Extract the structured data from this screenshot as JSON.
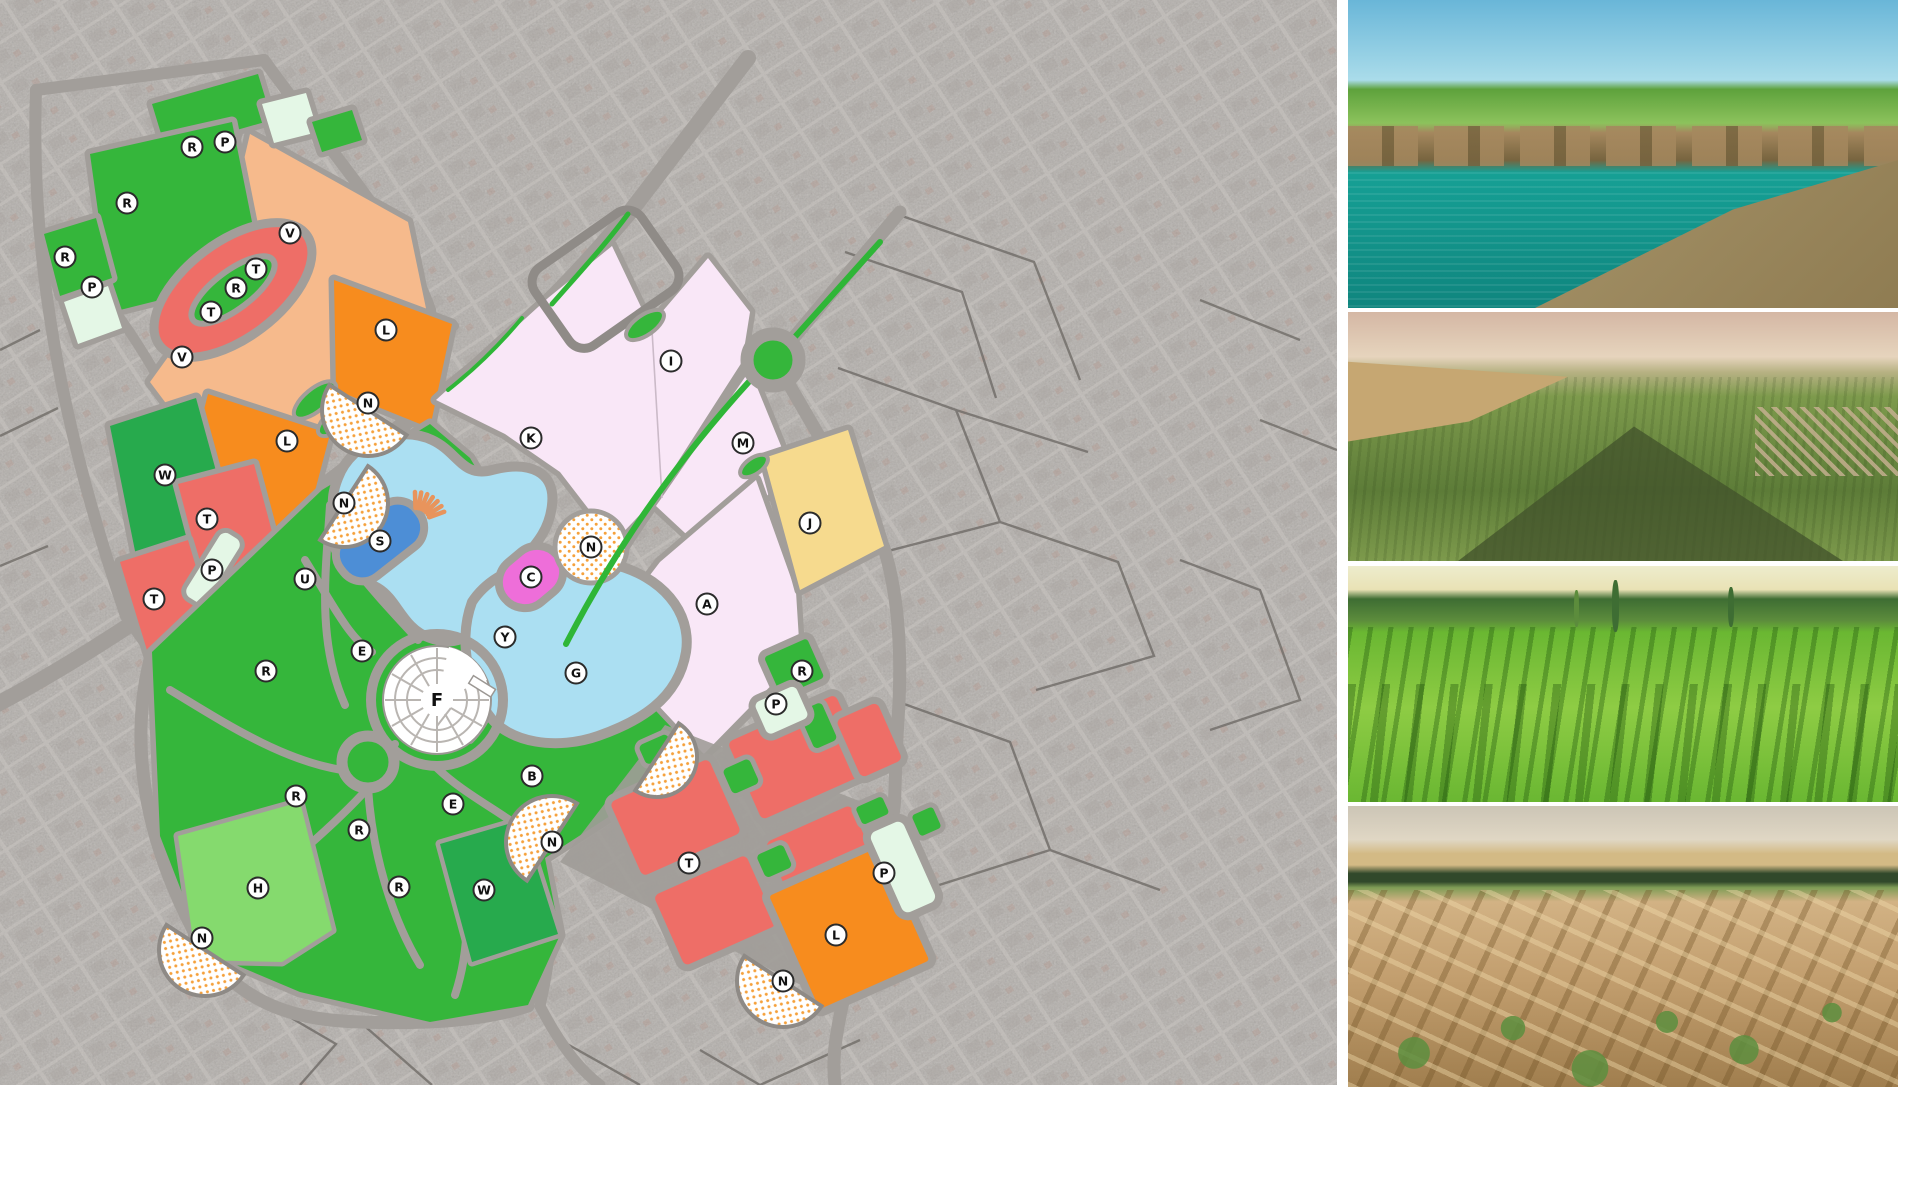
{
  "map": {
    "palette": {
      "sat": "#b4b0ac",
      "satline": "#c9c5c1",
      "road": "#a29e9a",
      "roadedge": "#6f6b67",
      "green": "#35b63b",
      "dgreen": "#27aa4d",
      "lgreen": "#85da6e",
      "mint": "#e4f7e6",
      "peach": "#f6ba8c",
      "red": "#ee6e67",
      "orange": "#f78c1e",
      "pink": "#f9e7f7",
      "yellow": "#f6da8e",
      "lake": "#abdff2",
      "pond": "#4d8ed6",
      "magenta": "#ee6ed9",
      "dot": "#f5a13c",
      "marker_ring": "#2b2b2b",
      "marker_text": "#111111",
      "sun": "#e8945c"
    },
    "markers": [
      {
        "letter": "R",
        "x": 192,
        "y": 147
      },
      {
        "letter": "P",
        "x": 225,
        "y": 142
      },
      {
        "letter": "R",
        "x": 127,
        "y": 203
      },
      {
        "letter": "R",
        "x": 65,
        "y": 257
      },
      {
        "letter": "P",
        "x": 92,
        "y": 287
      },
      {
        "letter": "V",
        "x": 290,
        "y": 233
      },
      {
        "letter": "T",
        "x": 256,
        "y": 269
      },
      {
        "letter": "R",
        "x": 236,
        "y": 288
      },
      {
        "letter": "T",
        "x": 211,
        "y": 312
      },
      {
        "letter": "V",
        "x": 182,
        "y": 357
      },
      {
        "letter": "L",
        "x": 386,
        "y": 330
      },
      {
        "letter": "N",
        "x": 368,
        "y": 403
      },
      {
        "letter": "L",
        "x": 287,
        "y": 441
      },
      {
        "letter": "W",
        "x": 165,
        "y": 475
      },
      {
        "letter": "T",
        "x": 207,
        "y": 519
      },
      {
        "letter": "P",
        "x": 212,
        "y": 570
      },
      {
        "letter": "T",
        "x": 154,
        "y": 599
      },
      {
        "letter": "U",
        "x": 305,
        "y": 579
      },
      {
        "letter": "N",
        "x": 344,
        "y": 503
      },
      {
        "letter": "K",
        "x": 531,
        "y": 438
      },
      {
        "letter": "I",
        "x": 671,
        "y": 361
      },
      {
        "letter": "M",
        "x": 743,
        "y": 443
      },
      {
        "letter": "S",
        "x": 380,
        "y": 541
      },
      {
        "letter": "C",
        "x": 531,
        "y": 577
      },
      {
        "letter": "N",
        "x": 591,
        "y": 547
      },
      {
        "letter": "Y",
        "x": 505,
        "y": 637
      },
      {
        "letter": "A",
        "x": 707,
        "y": 604
      },
      {
        "letter": "G",
        "x": 576,
        "y": 673
      },
      {
        "letter": "F",
        "x": 437,
        "y": 700,
        "plain": true
      },
      {
        "letter": "E",
        "x": 362,
        "y": 651
      },
      {
        "letter": "R",
        "x": 266,
        "y": 671
      },
      {
        "letter": "R",
        "x": 296,
        "y": 796
      },
      {
        "letter": "E",
        "x": 453,
        "y": 804
      },
      {
        "letter": "B",
        "x": 532,
        "y": 776
      },
      {
        "letter": "R",
        "x": 359,
        "y": 830
      },
      {
        "letter": "H",
        "x": 258,
        "y": 888
      },
      {
        "letter": "R",
        "x": 399,
        "y": 887
      },
      {
        "letter": "W",
        "x": 484,
        "y": 890
      },
      {
        "letter": "N",
        "x": 202,
        "y": 938
      },
      {
        "letter": "N",
        "x": 552,
        "y": 842
      },
      {
        "letter": "T",
        "x": 689,
        "y": 863
      },
      {
        "letter": "J",
        "x": 810,
        "y": 523
      },
      {
        "letter": "R",
        "x": 802,
        "y": 671
      },
      {
        "letter": "P",
        "x": 776,
        "y": 704
      },
      {
        "letter": "P",
        "x": 884,
        "y": 873
      },
      {
        "letter": "L",
        "x": 836,
        "y": 935
      },
      {
        "letter": "N",
        "x": 783,
        "y": 981
      }
    ]
  },
  "photos": [
    {
      "id": "photo-lake-ruins",
      "description": "turquoise lake with stone ruins and green hills",
      "colors": [
        "#69b6d8",
        "#aadcea",
        "#5ea23c",
        "#8cc25c",
        "#a5885e",
        "#77643f",
        "#16a095",
        "#0f857e",
        "#b4a176",
        "#8f7c52"
      ]
    },
    {
      "id": "photo-aerial-orchards",
      "description": "aerial view of orchard plains with hazy horizon and hill shadow",
      "colors": [
        "#d4b7a4",
        "#e6d4bd",
        "#b8b284",
        "#7d9a4c",
        "#5d7c38",
        "#c6a772",
        "#42532c",
        "#c9b193"
      ]
    },
    {
      "id": "photo-vineyard",
      "description": "green vineyard rows with poplar trees on the horizon",
      "colors": [
        "#edeccd",
        "#e9e2b5",
        "#3e6d33",
        "#5c8c3c",
        "#6ab732",
        "#8ecc44",
        "#3f7d22",
        "#356a1e"
      ]
    },
    {
      "id": "photo-mudbrick-ruins",
      "description": "ancient mud-brick ruins with shrubs and distant tree line",
      "colors": [
        "#ccc5b6",
        "#e0d7c4",
        "#d3ba85",
        "#31492b",
        "#7e9c55",
        "#d2b284",
        "#c29e6e",
        "#a07e4e",
        "#5d8f3f",
        "#caa877"
      ]
    }
  ]
}
